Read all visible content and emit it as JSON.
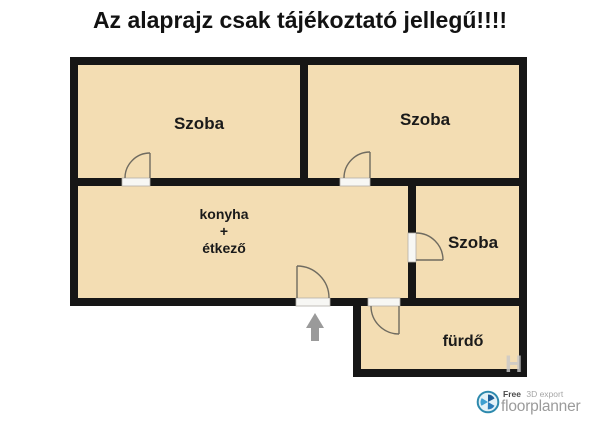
{
  "title": "Az alaprajz csak tájékoztató jellegű!!!!",
  "plan": {
    "rooms": {
      "szoba_top_left": "Szoba",
      "szoba_top_right": "Szoba",
      "kitchen_line1": "konyha",
      "kitchen_line2": "+",
      "kitchen_line3": "étkező",
      "szoba_right": "Szoba",
      "bathroom": "fürdő"
    },
    "watermark": "H",
    "colors": {
      "room_fill": "#f3ddb3",
      "wall": "#161616",
      "arrow": "#9a9a9a",
      "threshold": "#f7f7f4",
      "door_line": "#6f6b60"
    }
  },
  "footer": {
    "brand": "floorplanner",
    "tagline_bold": "Free",
    "tagline_rest": "3D export",
    "brand_color": "#2d89ad"
  }
}
